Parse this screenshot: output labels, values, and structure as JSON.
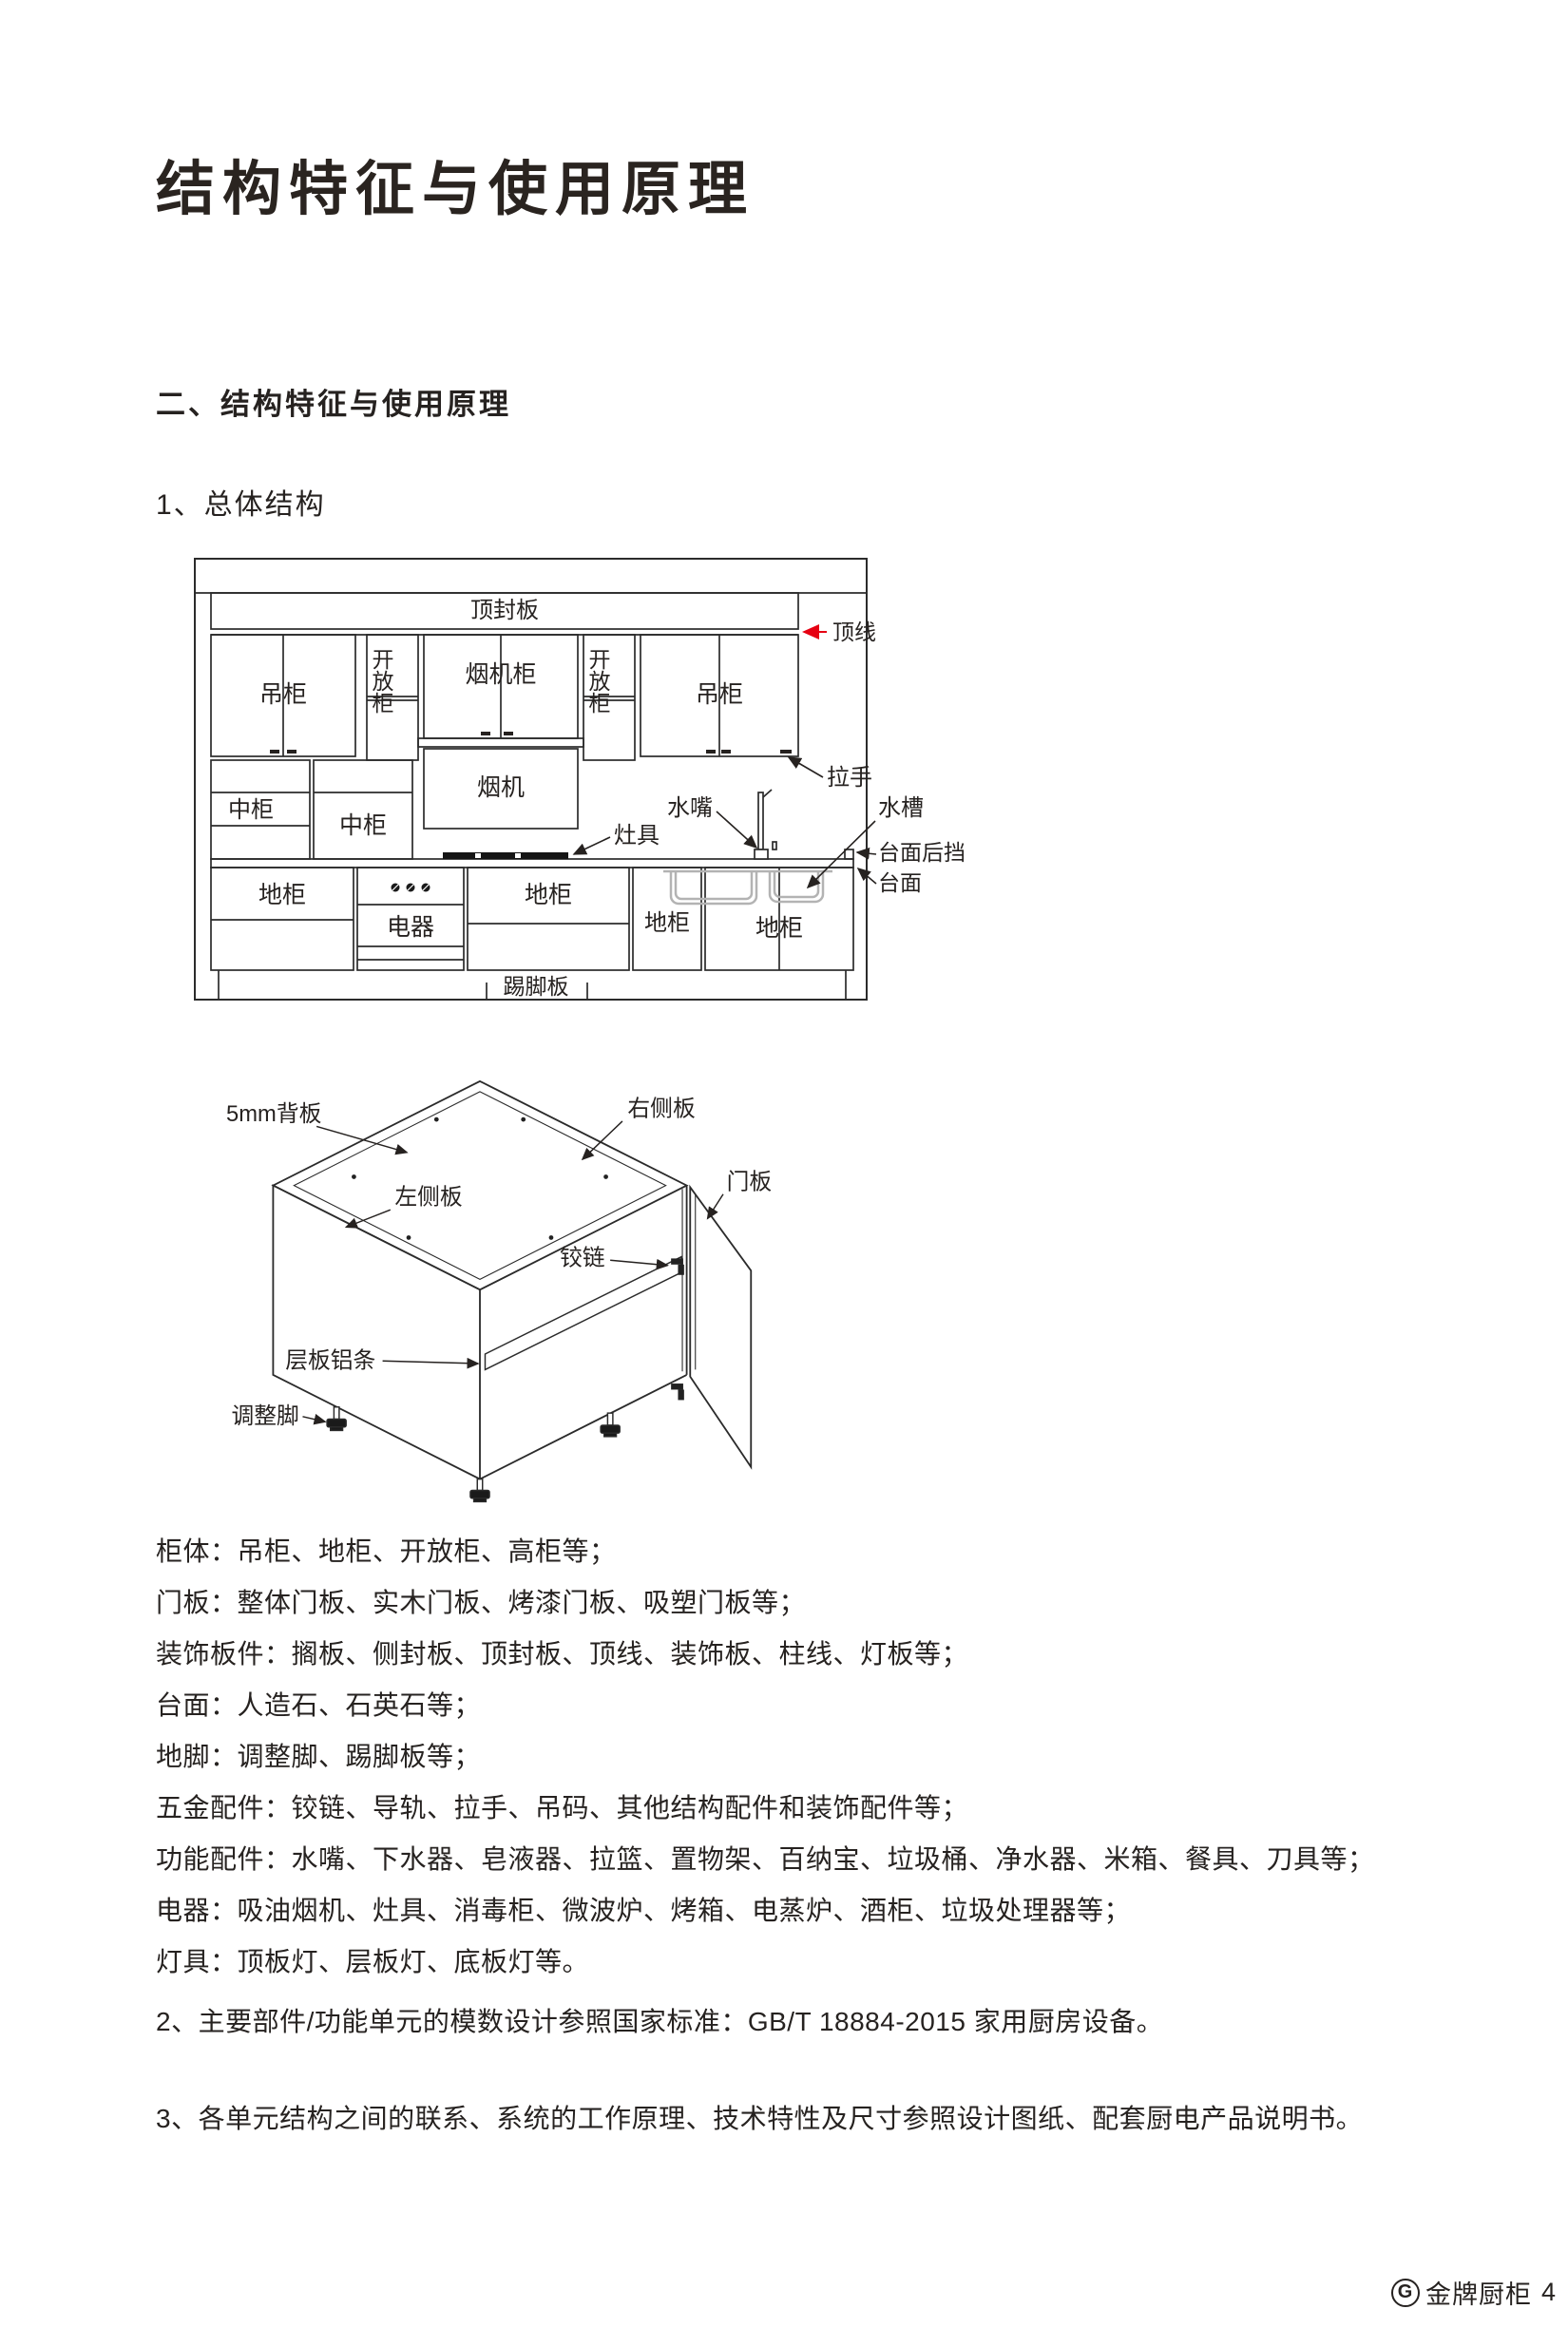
{
  "colors": {
    "text": "#262220",
    "line": "#2b2b2b",
    "red_arrow": "#e60012",
    "sink_gray": "#b3b3b3"
  },
  "headings": {
    "title": "结构特征与使用原理",
    "section": "二、结构特征与使用原理",
    "subsection": "1、总体结构"
  },
  "elevation": {
    "labels": {
      "top_board": "顶封板",
      "crown_line": "顶线",
      "wall_cabinet": "吊柜",
      "open_cabinet": "开放柜",
      "hood_cabinet": "烟机柜",
      "handle": "拉手",
      "mid_cabinet": "中柜",
      "hood": "烟机",
      "cooktop": "灶具",
      "faucet": "水嘴",
      "sink": "水槽",
      "counter_backsplash": "台面后挡",
      "countertop": "台面",
      "base_cabinet": "地柜",
      "appliance": "电器",
      "toe_kick": "踢脚板"
    }
  },
  "cabinet3d": {
    "labels": {
      "back_panel": "5mm背板",
      "right_panel": "右侧板",
      "left_panel": "左侧板",
      "hinge": "铰链",
      "door_panel": "门板",
      "shelf_strip": "层板铝条",
      "adjust_foot": "调整脚"
    }
  },
  "component_list": [
    "柜体：吊柜、地柜、开放柜、高柜等；",
    "门板：整体门板、实木门板、烤漆门板、吸塑门板等；",
    "装饰板件：搁板、侧封板、顶封板、顶线、装饰板、柱线、灯板等；",
    "台面：人造石、石英石等；",
    "地脚：调整脚、踢脚板等；",
    "五金配件：铰链、导轨、拉手、吊码、其他结构配件和装饰配件等；",
    "功能配件：水嘴、下水器、皂液器、拉篮、置物架、百纳宝、垃圾桶、净水器、米箱、餐具、刀具等；",
    "电器：吸油烟机、灶具、消毒柜、微波炉、烤箱、电蒸炉、酒柜、垃圾处理器等；",
    "灯具：顶板灯、层板灯、底板灯等。"
  ],
  "paragraphs": {
    "p2": "2、主要部件/功能单元的模数设计参照国家标准：GB/T 18884-2015 家用厨房设备。",
    "p3": "3、各单元结构之间的联系、系统的工作原理、技术特性及尺寸参照设计图纸、配套厨电产品说明书。"
  },
  "footer": {
    "logo_letter": "G",
    "brand": "金牌厨柜",
    "page_number": "4"
  }
}
